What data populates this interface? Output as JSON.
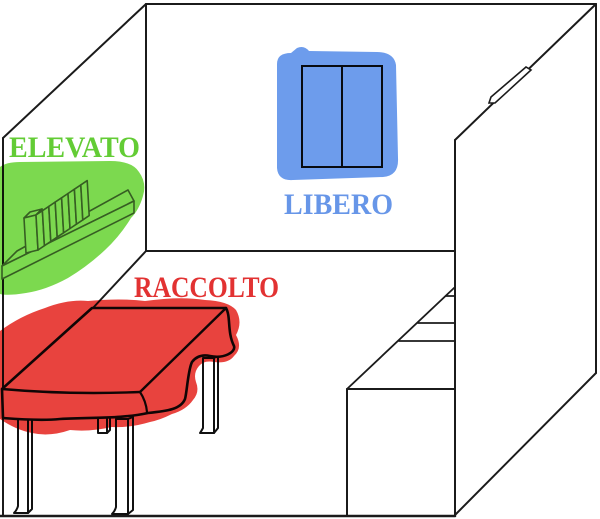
{
  "scene": {
    "type": "hand-drawn room sketch with highlighted zones",
    "background": "#ffffff",
    "line_color": "#1b1b1b",
    "zones": [
      {
        "id": "elevato",
        "label": "ELEVATO",
        "object": "wall shelf with row of books",
        "label_color": "#63cc35",
        "highlight_color": "#7cd94f"
      },
      {
        "id": "libero",
        "label": "LIBERO",
        "object": "two-pane window on back wall",
        "label_color": "#6796e8",
        "highlight_color": "#6d9cec"
      },
      {
        "id": "raccolto",
        "label": "RACCOLTO",
        "object": "four-legged table",
        "label_color": "#e23232",
        "highlight_color": "#e8433e"
      }
    ],
    "unlabeled_objects": [
      "tall wardrobe on right side",
      "stair-step storage box beside wardrobe"
    ]
  }
}
